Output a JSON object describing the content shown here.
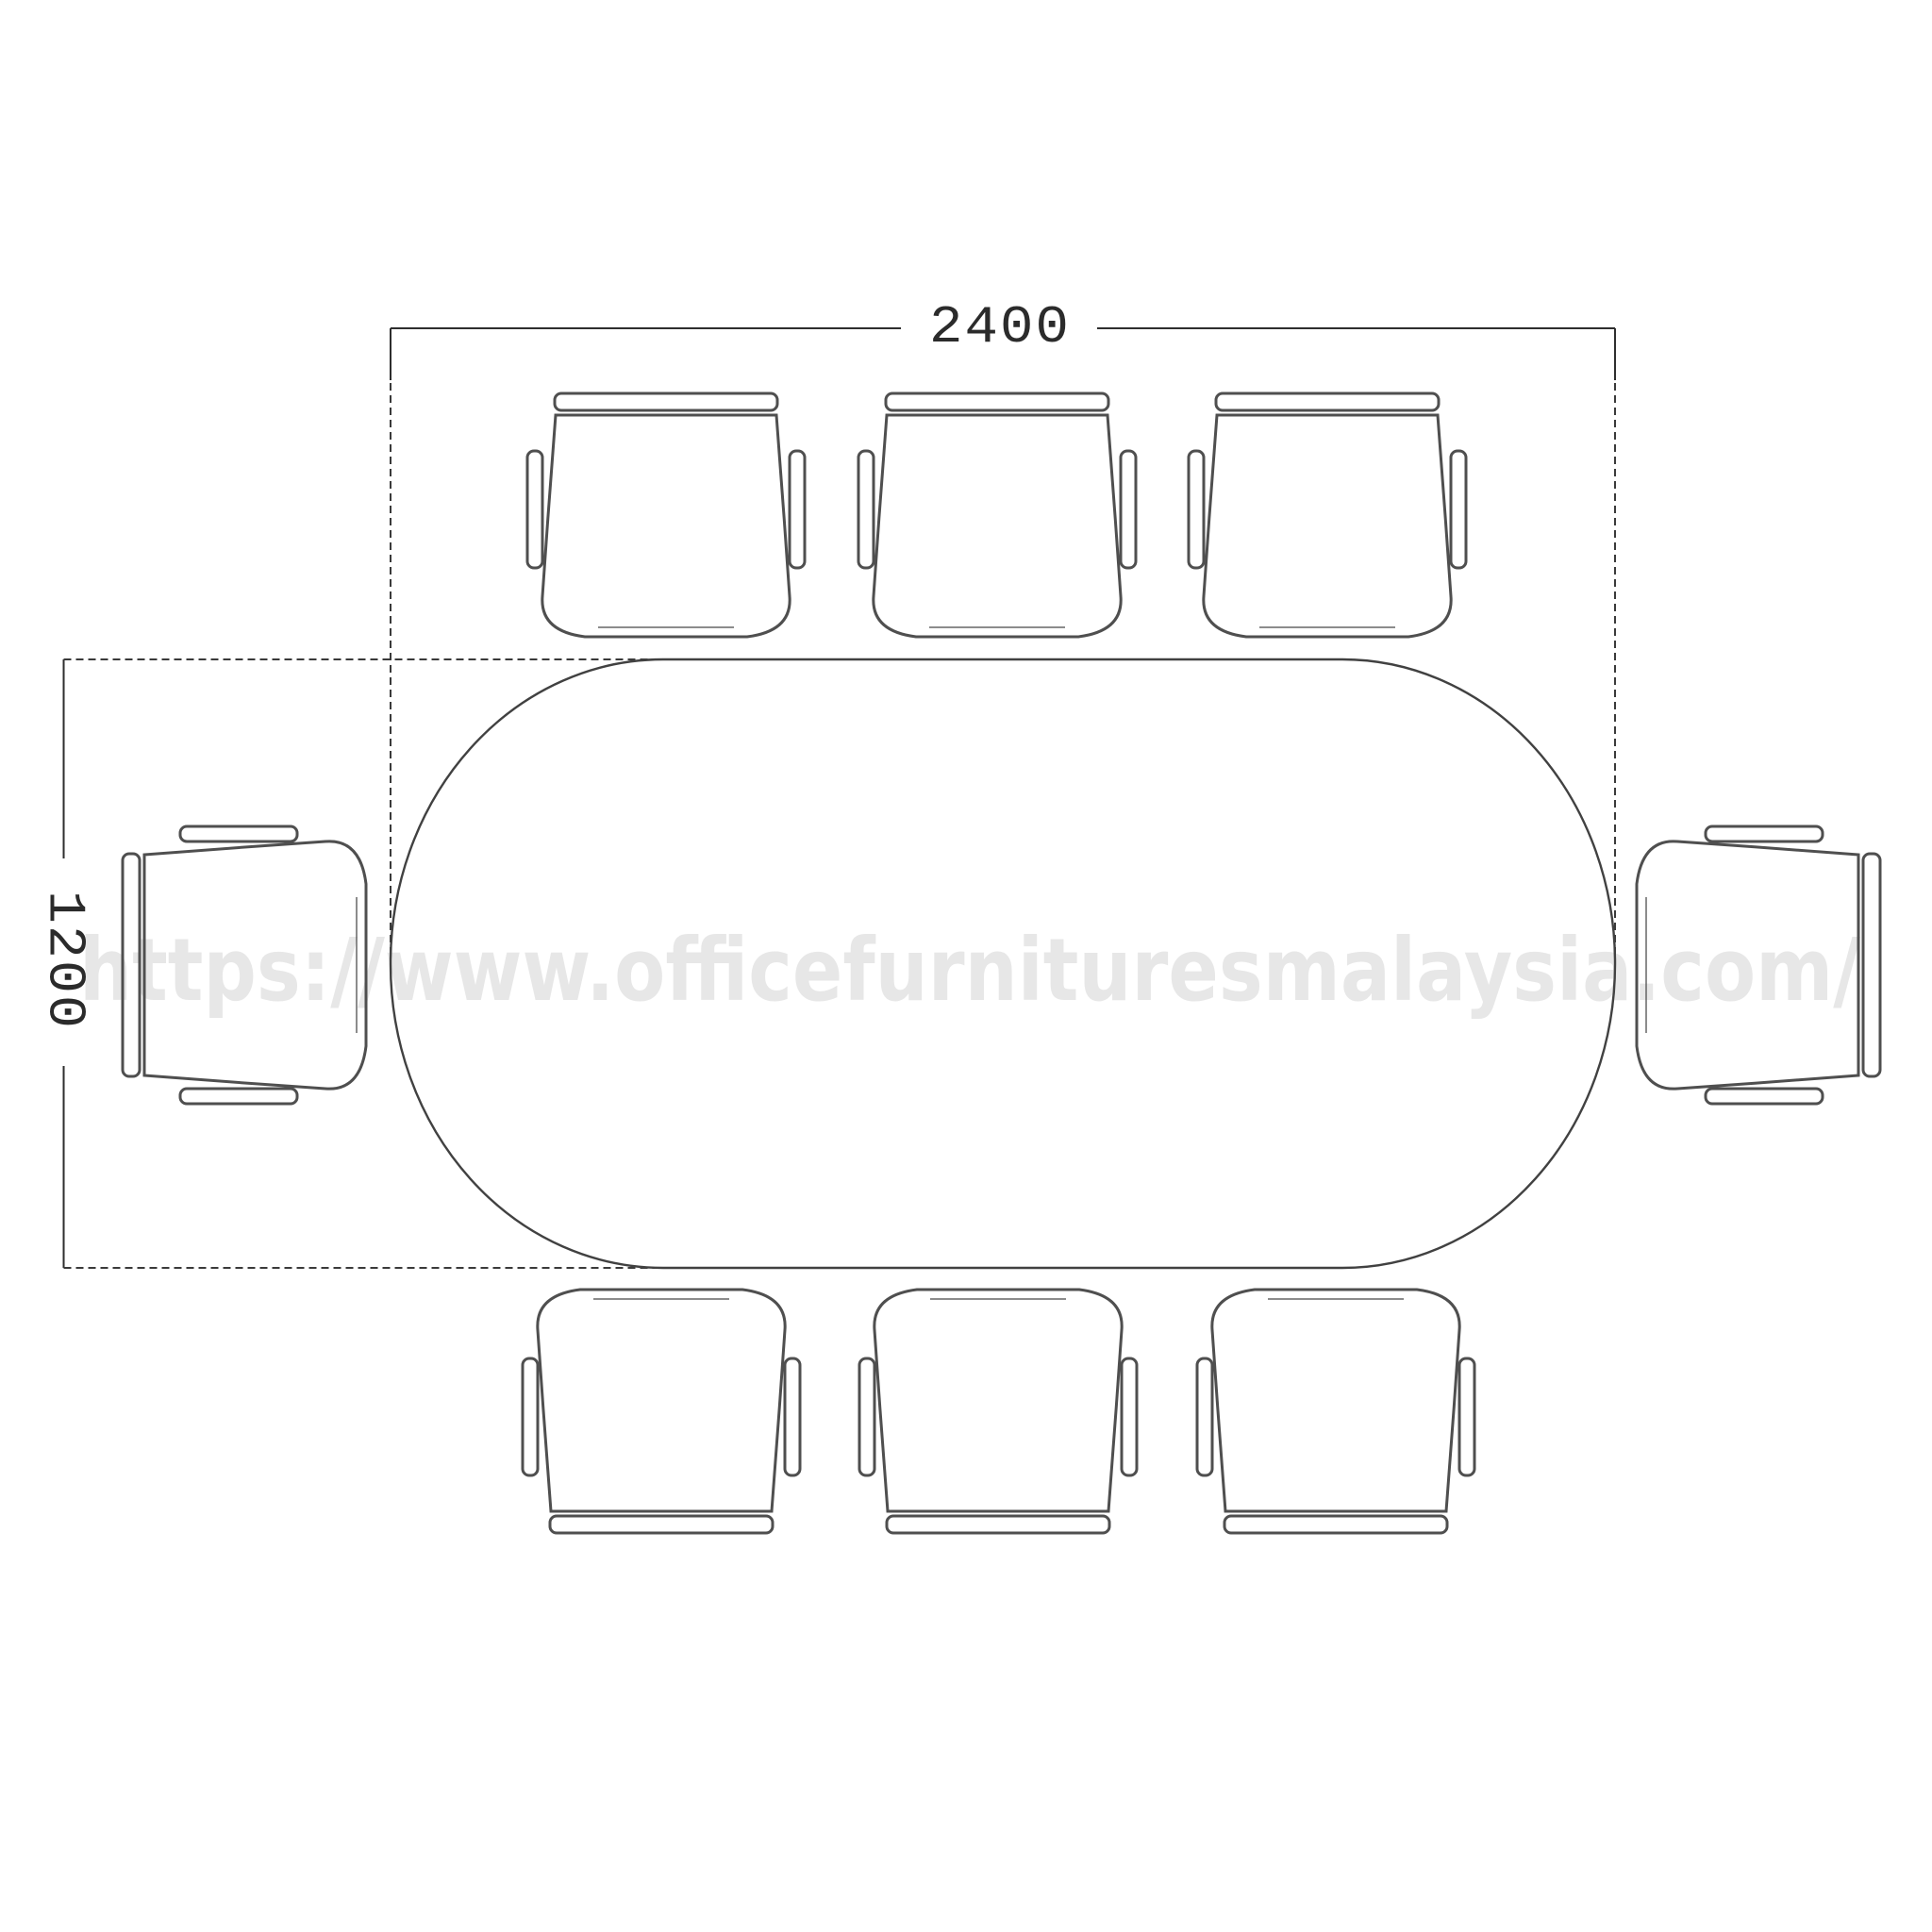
{
  "diagram": {
    "dimensions": {
      "width": {
        "label": "2400"
      },
      "height": {
        "label": "1200"
      }
    },
    "watermark": "https://www.officefurnituresmalaysia.com/",
    "table": {
      "shape": "oval-conference-table"
    },
    "chairs": {
      "top_row": 3,
      "bottom_row": 3,
      "left_side": 1,
      "right_side": 1,
      "total": 8
    },
    "colors": {
      "outline": "#414141",
      "chair_outline": "#4f4f4f",
      "dimension_text": "#2b2b2b",
      "watermark": "#e7e7e7",
      "background": "#ffffff"
    }
  }
}
